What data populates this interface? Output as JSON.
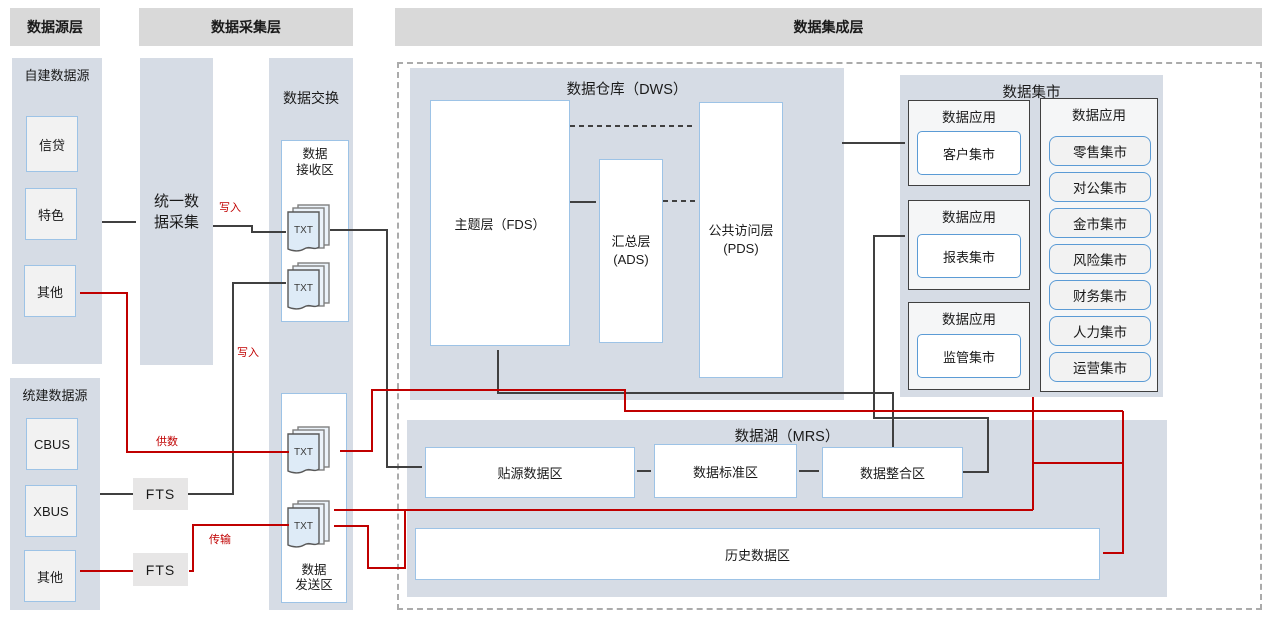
{
  "headers": {
    "source": "数据源层",
    "collection": "数据采集层",
    "integration": "数据集成层"
  },
  "source_layer": {
    "self_built": {
      "title": "自建数据源",
      "items": [
        "信贷",
        "特色",
        "其他"
      ]
    },
    "unified": {
      "title": "统建数据源",
      "items": [
        "CBUS",
        "XBUS",
        "其他"
      ]
    }
  },
  "collection_layer": {
    "unified_collection": {
      "line1": "统一数",
      "line2": "据采集"
    },
    "fts": "FTS",
    "exchange": {
      "title": "数据交换",
      "txt": "TXT",
      "receive": {
        "line1": "数据",
        "line2": "接收区"
      },
      "send": {
        "line1": "数据",
        "line2": "发送区"
      }
    }
  },
  "integration_layer": {
    "dws": {
      "title": "数据仓库（DWS）",
      "fds": "主题层（FDS）",
      "ads": {
        "line1": "汇总层",
        "line2": "(ADS)"
      },
      "pds": {
        "line1": "公共访问层",
        "line2": "(PDS)"
      }
    },
    "marts": {
      "title": "数据集市",
      "app_label": "数据应用",
      "left": [
        "客户集市",
        "报表集市",
        "监管集市"
      ],
      "right": [
        "零售集市",
        "对公集市",
        "金市集市",
        "风险集市",
        "财务集市",
        "人力集市",
        "运营集市"
      ]
    },
    "mrs": {
      "title": "数据湖（MRS）",
      "zones": [
        "贴源数据区",
        "数据标准区",
        "数据整合区"
      ],
      "history": "历史数据区"
    }
  },
  "edge_labels": {
    "write1": "写入",
    "write2": "写入",
    "supply": "供数",
    "transfer": "传输"
  },
  "colors": {
    "red": "#C00000",
    "black": "#404040",
    "container": "#D6DCE5",
    "header_gray": "#D9D9D9",
    "blue_border": "#9DC3E6",
    "mart_border": "#5B9BD5",
    "txt_fill": "#DEEBF7"
  }
}
